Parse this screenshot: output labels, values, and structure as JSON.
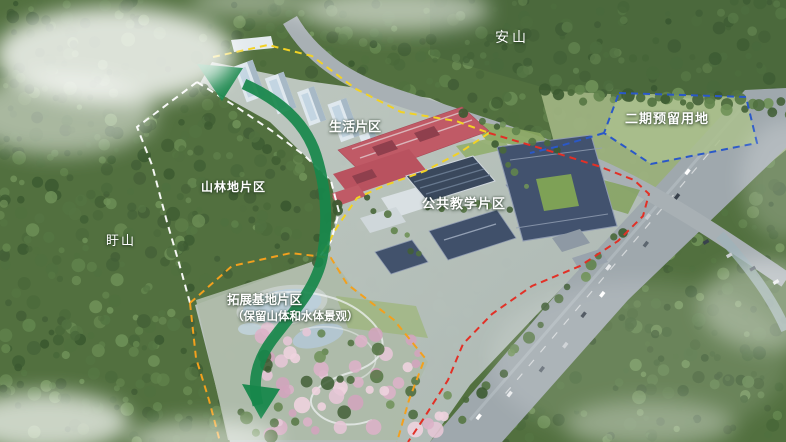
{
  "title": "校园总体规划鸟瞰图",
  "labels": {
    "anshan": "安山",
    "phase2_reserved": "二期预留用地",
    "living_area": "生活片区",
    "forest_area": "山林地片区",
    "xushan": "盱山",
    "teaching_area": "公共教学片区",
    "expansion_area": "拓展基地片区",
    "expansion_note": "（保留山体和水体景观）"
  },
  "legend_colors": {
    "campus_boundary_yellow": "#F2D224",
    "expansion_boundary_orange": "#F2A01E",
    "road_boundary_red": "#E23026",
    "phase2_boundary_blue": "#2A58C8",
    "forest_boundary_white": "#FFFFFF",
    "landscape_axis_green": "#17874B"
  }
}
